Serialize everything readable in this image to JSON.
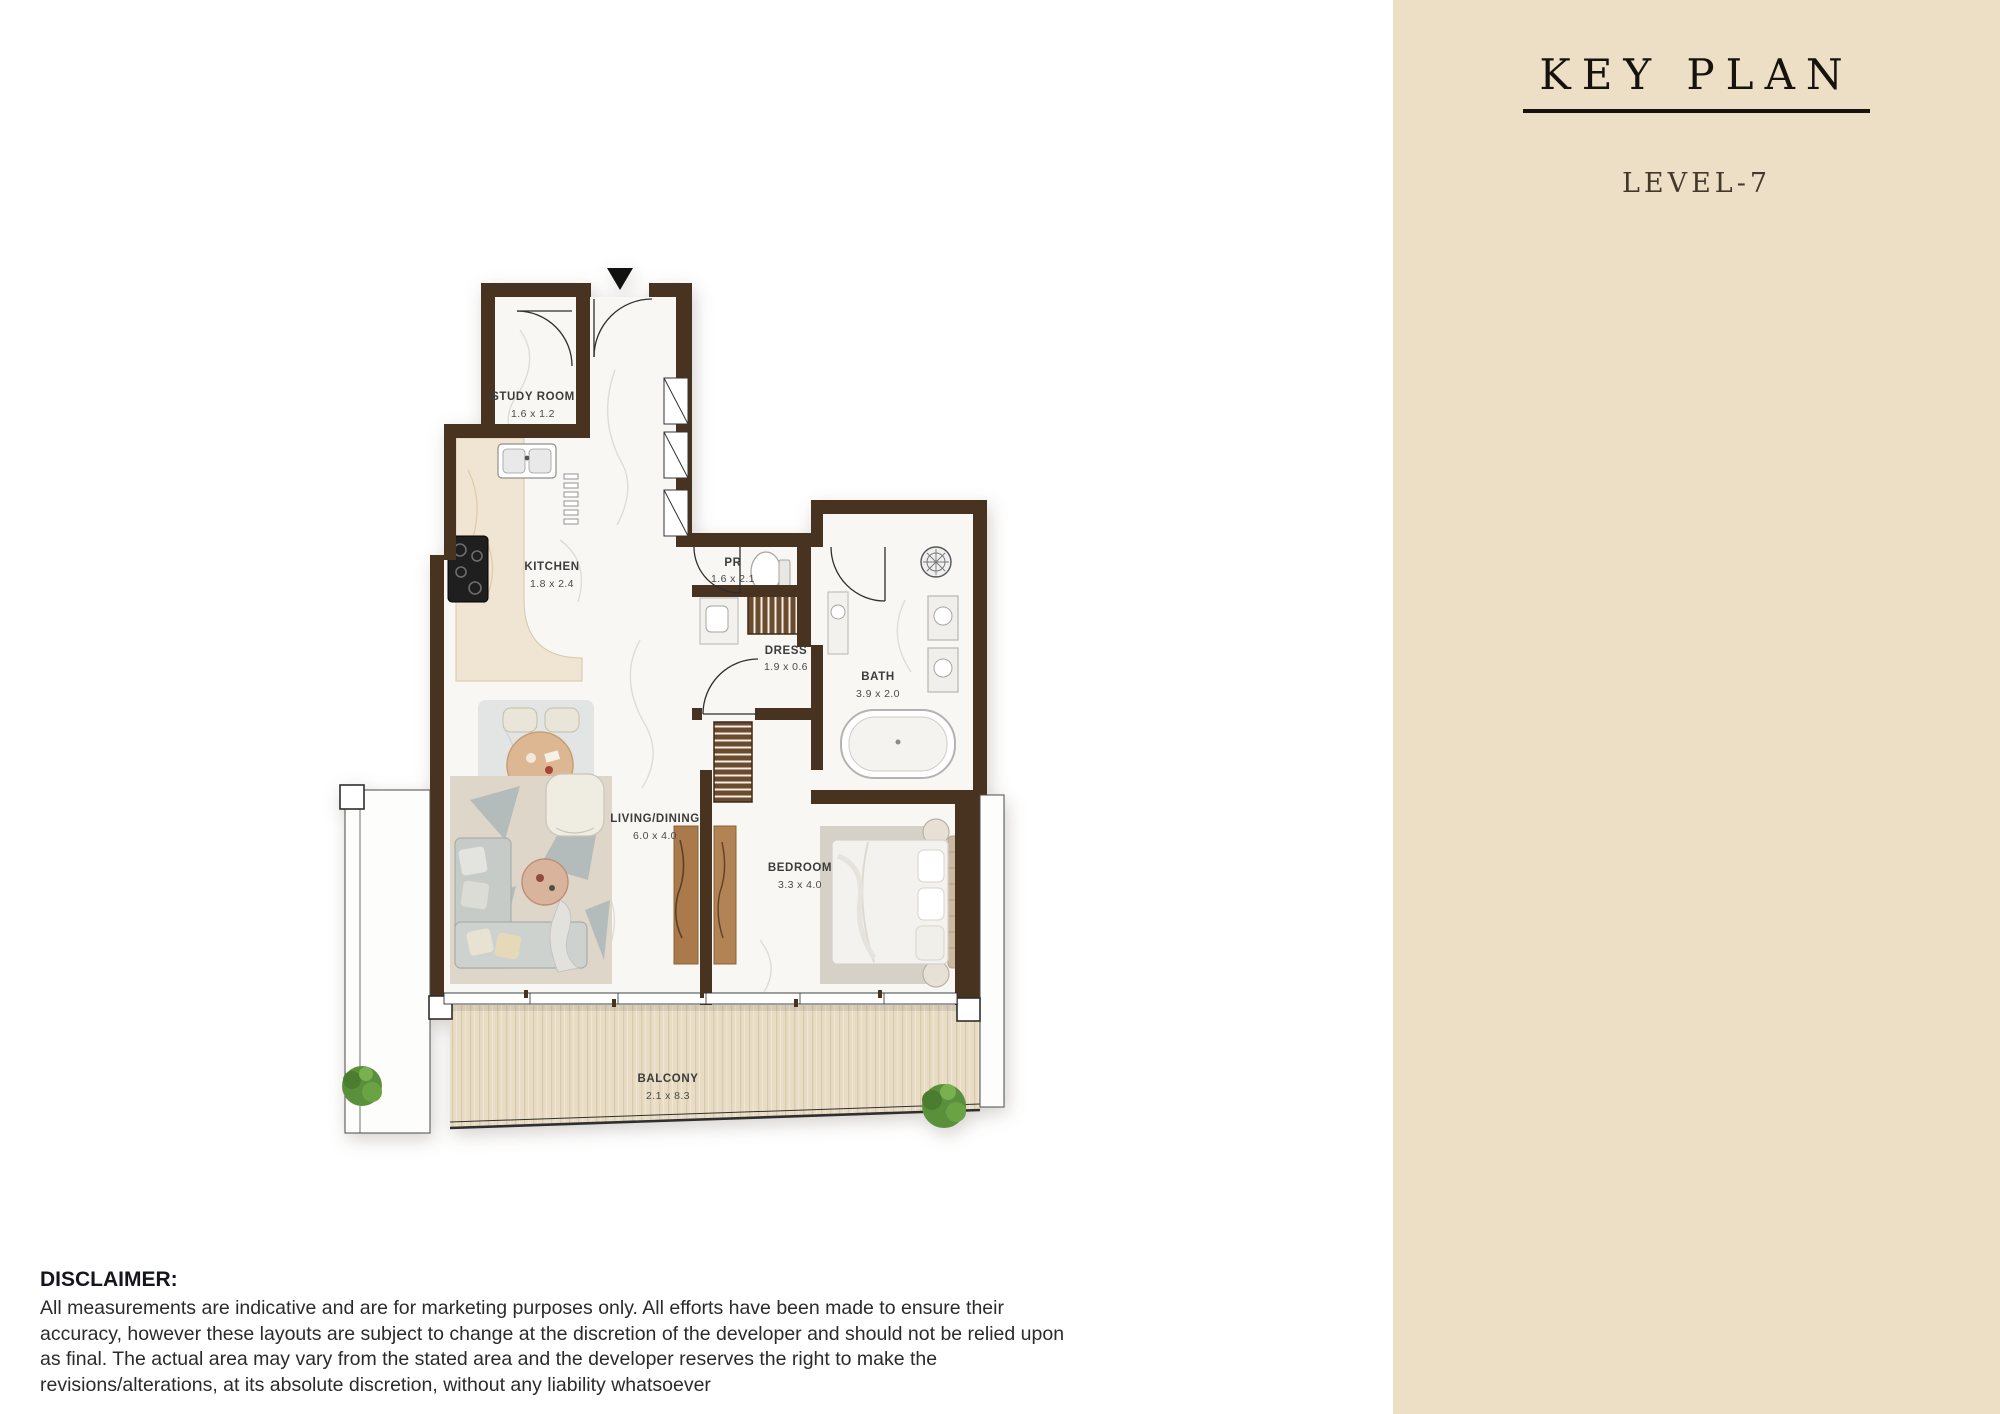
{
  "sidebar": {
    "title": "KEY PLAN",
    "level": "LEVEL-7",
    "compass": {
      "n": "N",
      "e": "E",
      "s": "S",
      "w": "W"
    },
    "unit_card": {
      "type_label": "1BHK-2BATH",
      "unit_number": "A-710",
      "areas": [
        {
          "label": "Internal Living Area",
          "sqm": "75.62",
          "sqm_unit": "sqm.",
          "sqft": "813.97",
          "sqft_unit": "sq.ft."
        },
        {
          "label": "External Living Area",
          "sqm": "18.23",
          "sqm_unit": "sqm.",
          "sqft": "196.23",
          "sqft_unit": "sq.ft."
        }
      ],
      "total": {
        "label": "Total Living Area",
        "sqm": "93.85",
        "sqm_unit": "sqm.",
        "sqft": "1010.19",
        "sqft_unit": "sq.ft."
      }
    }
  },
  "floor_plan": {
    "rooms": [
      {
        "name": "STUDY ROOM",
        "dims": "1.6 x 1.2"
      },
      {
        "name": "KITCHEN",
        "dims": "1.8 x 2.4"
      },
      {
        "name": "PR",
        "dims": "1.6 x 2.1"
      },
      {
        "name": "DRESS",
        "dims": "1.9 x 0.6"
      },
      {
        "name": "BATH",
        "dims": "3.9 x 2.0"
      },
      {
        "name": "LIVING/DINING",
        "dims": "6.0 x 4.0"
      },
      {
        "name": "BEDROOM",
        "dims": "3.3 x 4.0"
      },
      {
        "name": "BALCONY",
        "dims": "2.1 x 8.3"
      }
    ]
  },
  "disclaimer": {
    "heading": "DISCLAIMER:",
    "body": "All measurements are indicative and are for marketing purposes only. All efforts have been made to ensure their accuracy, however these layouts are subject to change at the discretion of the developer and should not be relied upon as final. The actual area may vary from the stated area and the developer reserves the right to make the revisions/alterations, at its absolute discretion, without any liability whatsoever"
  },
  "colors": {
    "accent": "#e7a33c",
    "wall": "#483321",
    "sidebar_bg": "#ecdfc6",
    "card_bg": "#f5ecdb"
  }
}
